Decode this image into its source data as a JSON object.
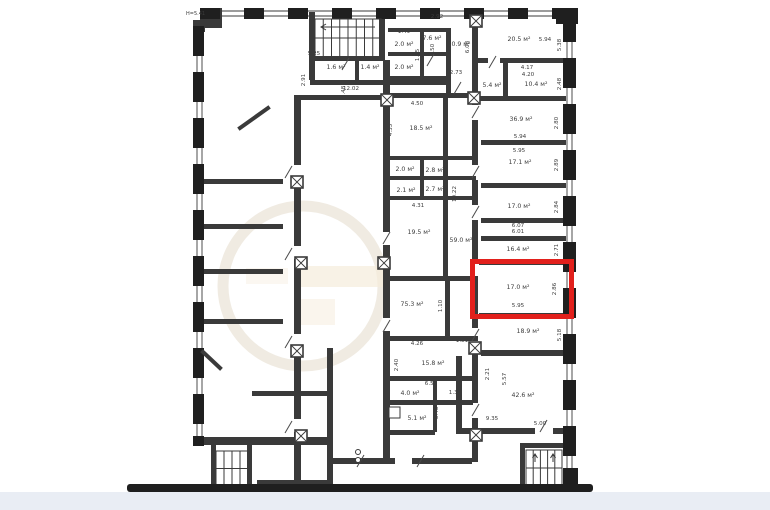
{
  "colors": {
    "paper": "#ffffff",
    "wall": "#3a3a3a",
    "wall2": "#1f1f1f",
    "ground": "#e9edf4",
    "label": "#3c3c3c",
    "watermark": "#f5ecdc"
  },
  "plan": {
    "note": "Н=5.41",
    "highlight": {
      "color": "#e2201c",
      "room_area": "17.0 м²",
      "room_width_m": "5.95",
      "room_depth_m": "2.86"
    },
    "labels": [
      {
        "t": "2.92",
        "x": 437,
        "y": 18
      },
      {
        "t": "1.49",
        "x": 404,
        "y": 33
      },
      {
        "t": "7.6 м²",
        "x": 432,
        "y": 40
      },
      {
        "t": "2.0 м²",
        "x": 404,
        "y": 46
      },
      {
        "t": "10.9 м²",
        "x": 459,
        "y": 46
      },
      {
        "t": "4.50",
        "x": 434,
        "y": 50,
        "r": 1
      },
      {
        "t": "6.08",
        "x": 469,
        "y": 47,
        "r": 1
      },
      {
        "t": "1.95",
        "x": 419,
        "y": 55,
        "r": 1
      },
      {
        "t": "2.0 м²",
        "x": 404,
        "y": 69
      },
      {
        "t": "20.5 м²",
        "x": 519,
        "y": 41
      },
      {
        "t": "5.94",
        "x": 545,
        "y": 41
      },
      {
        "t": "5.38",
        "x": 561,
        "y": 45,
        "r": 1
      },
      {
        "t": "5.25",
        "x": 314,
        "y": 55
      },
      {
        "t": "1.6 м²",
        "x": 336,
        "y": 69
      },
      {
        "t": "1.4 м²",
        "x": 370,
        "y": 69
      },
      {
        "t": "2.91",
        "x": 305,
        "y": 80,
        "r": 1
      },
      {
        "t": "12.02",
        "x": 351,
        "y": 90
      },
      {
        "t": "5.48",
        "x": 345,
        "y": 92,
        "r": 1
      },
      {
        "t": "2.73",
        "x": 456,
        "y": 74
      },
      {
        "t": "4.17",
        "x": 527,
        "y": 69
      },
      {
        "t": "4.20",
        "x": 528,
        "y": 76
      },
      {
        "t": "5.4 м²",
        "x": 492,
        "y": 87
      },
      {
        "t": "10.4 м²",
        "x": 536,
        "y": 86
      },
      {
        "t": "2.48",
        "x": 561,
        "y": 84,
        "r": 1
      },
      {
        "t": "4.50",
        "x": 417,
        "y": 105
      },
      {
        "t": "18.5 м²",
        "x": 421,
        "y": 130
      },
      {
        "t": "4.35",
        "x": 392,
        "y": 130,
        "r": 1
      },
      {
        "t": "36.9 м²",
        "x": 521,
        "y": 121
      },
      {
        "t": "2.80",
        "x": 558,
        "y": 123,
        "r": 1
      },
      {
        "t": "5.94",
        "x": 520,
        "y": 138
      },
      {
        "t": "5.95",
        "x": 519,
        "y": 152
      },
      {
        "t": "17.1 м²",
        "x": 520,
        "y": 164
      },
      {
        "t": "2.89",
        "x": 558,
        "y": 165,
        "r": 1
      },
      {
        "t": "2.0 м²",
        "x": 405,
        "y": 171
      },
      {
        "t": "2.8 м²",
        "x": 435,
        "y": 172
      },
      {
        "t": "2.1 м²",
        "x": 406,
        "y": 192
      },
      {
        "t": "2.7 м²",
        "x": 435,
        "y": 191
      },
      {
        "t": "4.31",
        "x": 418,
        "y": 207
      },
      {
        "t": "10.22",
        "x": 456,
        "y": 194,
        "r": 1
      },
      {
        "t": "17.0 м²",
        "x": 519,
        "y": 208
      },
      {
        "t": "2.84",
        "x": 558,
        "y": 207,
        "r": 1
      },
      {
        "t": "6.07",
        "x": 518,
        "y": 227
      },
      {
        "t": "6.01",
        "x": 518,
        "y": 233
      },
      {
        "t": "19.5 м²",
        "x": 419,
        "y": 234
      },
      {
        "t": "4.53",
        "x": 447,
        "y": 236,
        "r": 1
      },
      {
        "t": "59.0 м²",
        "x": 461,
        "y": 242
      },
      {
        "t": "16.4 м²",
        "x": 518,
        "y": 251
      },
      {
        "t": "2.71",
        "x": 558,
        "y": 250,
        "r": 1
      },
      {
        "t": "17.0 м²",
        "x": 518,
        "y": 289
      },
      {
        "t": "2.86",
        "x": 556,
        "y": 289,
        "r": 1
      },
      {
        "t": "5.95",
        "x": 518,
        "y": 307
      },
      {
        "t": "75.3 м²",
        "x": 412,
        "y": 306
      },
      {
        "t": "1.10",
        "x": 442,
        "y": 306,
        "r": 1
      },
      {
        "t": "18.9 м²",
        "x": 528,
        "y": 333
      },
      {
        "t": "5.18",
        "x": 561,
        "y": 335,
        "r": 1
      },
      {
        "t": "4.26",
        "x": 417,
        "y": 345
      },
      {
        "t": "1.81",
        "x": 462,
        "y": 342
      },
      {
        "t": "15.8 м²",
        "x": 433,
        "y": 365
      },
      {
        "t": "2.40",
        "x": 398,
        "y": 365,
        "r": 1
      },
      {
        "t": "2.21",
        "x": 489,
        "y": 374,
        "r": 1
      },
      {
        "t": "5.57",
        "x": 506,
        "y": 379,
        "r": 1
      },
      {
        "t": "6.57",
        "x": 431,
        "y": 385
      },
      {
        "t": "4.0 м²",
        "x": 410,
        "y": 395
      },
      {
        "t": "1.32",
        "x": 455,
        "y": 394
      },
      {
        "t": "42.6 м²",
        "x": 523,
        "y": 397
      },
      {
        "t": "5.1 м²",
        "x": 417,
        "y": 420
      },
      {
        "t": "3.46",
        "x": 438,
        "y": 413,
        "r": 1
      },
      {
        "t": "9.35",
        "x": 492,
        "y": 420
      },
      {
        "t": "5.00",
        "x": 540,
        "y": 425
      }
    ]
  }
}
